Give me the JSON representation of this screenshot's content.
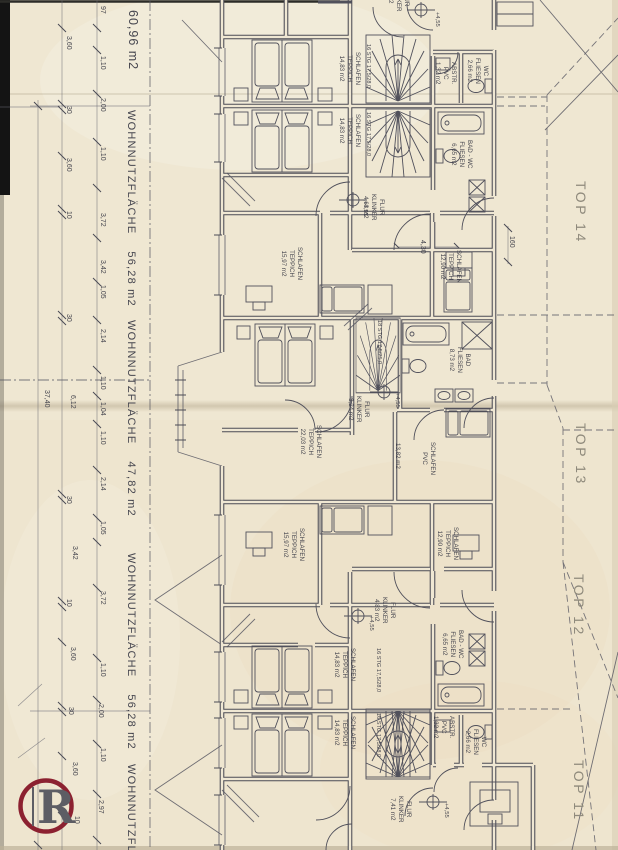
{
  "colors": {
    "paper": "#efe7d2",
    "ink": "#50505b",
    "faded_label": "#8f8a7c",
    "logo_ring": "#8c2130",
    "logo_letter": "#5d5d64"
  },
  "logo": {
    "letter": "R"
  },
  "labels": [
    {
      "n": "area-top",
      "t": "60,96 m2",
      "x": 141,
      "y": 10,
      "s": 12.5,
      "sp": 1
    },
    {
      "n": "area-top14",
      "t": "WOHNNUTZFLÄCHE    56,28 m2",
      "x": 138,
      "y": 110,
      "s": 11,
      "sp": 1.2
    },
    {
      "n": "area-top13",
      "t": "WOHNNUTZFLÄCHE    47,82 m2",
      "x": 138,
      "y": 320,
      "s": 11,
      "sp": 1.2
    },
    {
      "n": "area-top12",
      "t": "WOHNNUTZFLÄCHE    56,28 m2",
      "x": 138,
      "y": 553,
      "s": 11,
      "sp": 1.2
    },
    {
      "n": "area-top11",
      "t": "WOHNNUTZFLÄCHE",
      "x": 138,
      "y": 764,
      "s": 11,
      "sp": 1.2
    },
    {
      "n": "top-14",
      "t": "TOP 14",
      "x": 590,
      "y": 181,
      "s": 14,
      "sp": 2.5,
      "c": "#8f8a7c"
    },
    {
      "n": "top-13",
      "t": "TOP 13",
      "x": 590,
      "y": 423,
      "s": 14,
      "sp": 2.5,
      "c": "#8f8a7c"
    },
    {
      "n": "top-12",
      "t": "TOP 12",
      "x": 588,
      "y": 574,
      "s": 14,
      "sp": 2.5,
      "c": "#8f8a7c"
    },
    {
      "n": "top-11",
      "t": "TOP 11",
      "x": 588,
      "y": 760,
      "s": 14,
      "sp": 2.5,
      "c": "#8f8a7c"
    },
    {
      "n": "dim-97",
      "t": "97",
      "x": 107,
      "y": 6,
      "s": 7
    },
    {
      "n": "dim-360-a",
      "t": "3,60",
      "x": 73,
      "y": 36,
      "s": 7
    },
    {
      "n": "dim-110-a",
      "t": "1,10",
      "x": 107,
      "y": 56,
      "s": 7
    },
    {
      "n": "dim-200-a",
      "t": "2,00",
      "x": 107,
      "y": 98,
      "s": 7
    },
    {
      "n": "dim-30-a",
      "t": "30",
      "x": 73,
      "y": 106,
      "s": 7
    },
    {
      "n": "dim-110-b",
      "t": "1,10",
      "x": 107,
      "y": 147,
      "s": 7
    },
    {
      "n": "dim-360-b",
      "t": "3,60",
      "x": 73,
      "y": 158,
      "s": 7
    },
    {
      "n": "dim-372-a",
      "t": "3,72",
      "x": 107,
      "y": 213,
      "s": 7
    },
    {
      "n": "dim-10-a",
      "t": "10",
      "x": 73,
      "y": 211,
      "s": 7
    },
    {
      "n": "dim-342-a",
      "t": "3,42",
      "x": 107,
      "y": 260,
      "s": 7
    },
    {
      "n": "dim-105-a",
      "t": "1,05",
      "x": 107,
      "y": 285,
      "s": 7
    },
    {
      "n": "dim-30-b",
      "t": "30",
      "x": 73,
      "y": 314,
      "s": 7
    },
    {
      "n": "dim-214-a",
      "t": "2,14",
      "x": 107,
      "y": 329,
      "s": 7
    },
    {
      "n": "dim-110-c",
      "t": "1,10",
      "x": 107,
      "y": 376,
      "s": 7
    },
    {
      "n": "dim-104",
      "t": "1,04",
      "x": 107,
      "y": 402,
      "s": 7
    },
    {
      "n": "dim-612",
      "t": "6,12",
      "x": 77,
      "y": 395,
      "s": 7
    },
    {
      "n": "dim-3740",
      "t": "37,40",
      "x": 51,
      "y": 390,
      "s": 7
    },
    {
      "n": "dim-110-d",
      "t": "1,10",
      "x": 107,
      "y": 431,
      "s": 7
    },
    {
      "n": "dim-214-b",
      "t": "2,14",
      "x": 107,
      "y": 477,
      "s": 7
    },
    {
      "n": "dim-30-c",
      "t": "30",
      "x": 73,
      "y": 496,
      "s": 7
    },
    {
      "n": "dim-105-b",
      "t": "1,05",
      "x": 107,
      "y": 521,
      "s": 7
    },
    {
      "n": "dim-342-b",
      "t": "3,42",
      "x": 79,
      "y": 546,
      "s": 7
    },
    {
      "n": "dim-372-b",
      "t": "3,72",
      "x": 107,
      "y": 591,
      "s": 7
    },
    {
      "n": "dim-10-b",
      "t": "10",
      "x": 73,
      "y": 599,
      "s": 7
    },
    {
      "n": "dim-360-c",
      "t": "3,60",
      "x": 77,
      "y": 647,
      "s": 7
    },
    {
      "n": "dim-110-e",
      "t": "1,10",
      "x": 107,
      "y": 663,
      "s": 7
    },
    {
      "n": "dim-200-b",
      "t": "2,00",
      "x": 105,
      "y": 704,
      "s": 7
    },
    {
      "n": "dim-30-d",
      "t": "30",
      "x": 75,
      "y": 707,
      "s": 7
    },
    {
      "n": "dim-110-f",
      "t": "1,10",
      "x": 107,
      "y": 748,
      "s": 7
    },
    {
      "n": "dim-360-d",
      "t": "3,60",
      "x": 79,
      "y": 762,
      "s": 7
    },
    {
      "n": "dim-297",
      "t": "2,97",
      "x": 105,
      "y": 800,
      "s": 7
    },
    {
      "n": "dim-10-c",
      "t": "10",
      "x": 81,
      "y": 816,
      "s": 7
    },
    {
      "n": "dim-160",
      "t": "160",
      "x": 516,
      "y": 236,
      "s": 7
    },
    {
      "n": "dim-430",
      "t": "4,30",
      "x": 427,
      "y": 240,
      "s": 7
    },
    {
      "n": "room-schlafen-a",
      "t": "SCHLAFEN\nTEPPICH\n14,83 m2",
      "x": 361,
      "y": 52,
      "s": 6.2
    },
    {
      "n": "stairs-note-a",
      "t": "16 STG 17,5/28,0",
      "x": 371,
      "y": 44,
      "s": 5.6
    },
    {
      "n": "room-wc-a",
      "t": "WC\nFLIESEN\n2,66 m2",
      "x": 489,
      "y": 58,
      "s": 6.2
    },
    {
      "n": "room-abstr-a",
      "t": "ABSTR.\nPVC\n1,32 m2",
      "x": 457,
      "y": 62,
      "s": 6.2
    },
    {
      "n": "elev-a",
      "t": "+4,55",
      "x": 440,
      "y": 12,
      "s": 5.8
    },
    {
      "n": "room-flur-cut",
      "t": "FLUR\nKLINKER\n m2",
      "x": 410,
      "y": -15,
      "s": 6.2
    },
    {
      "n": "room-schlafen-b",
      "t": "SCHLAFEN\nTEPPICH\n14,83 m2",
      "x": 361,
      "y": 114,
      "s": 6.2
    },
    {
      "n": "stairs-note-b",
      "t": "16 STG 17,5/28,0",
      "x": 371,
      "y": 112,
      "s": 5.6
    },
    {
      "n": "room-badwc-b",
      "t": "BAD - WC\nFLIESEN\n6,65 m2",
      "x": 473,
      "y": 140,
      "s": 6.2
    },
    {
      "n": "room-flur-b",
      "t": "FLUR\nKLINKER\n4,63 m2",
      "x": 385,
      "y": 194,
      "s": 6.2
    },
    {
      "n": "elev-b",
      "t": "+4,55",
      "x": 368,
      "y": 201,
      "s": 5.8
    },
    {
      "n": "room-schlafen-c",
      "t": "SCHLAFEN\nTEPPICH\n15,97 m2",
      "x": 303,
      "y": 247,
      "s": 6.2
    },
    {
      "n": "room-schlafen-d",
      "t": "SCHLAFEN\nTEPPICH\n12,90 m2",
      "x": 462,
      "y": 250,
      "s": 6.2
    },
    {
      "n": "room-schlafen-e",
      "t": "SCHLAFEN\nTEPPICH\n22,03 m2",
      "x": 322,
      "y": 425,
      "s": 6.2
    },
    {
      "n": "stairs-note-c",
      "t": "18 STG 17,5/25,0",
      "x": 382,
      "y": 320,
      "s": 5.6
    },
    {
      "n": "room-bad-c",
      "t": "BAD\nFLIESEN\n8,73 m2",
      "x": 471,
      "y": 347,
      "s": 6.2
    },
    {
      "n": "room-flur-c",
      "t": "FLUR\nKLINKER\n3,24 m2",
      "x": 370,
      "y": 396,
      "s": 6.2
    },
    {
      "n": "elev-c",
      "t": "+4,55",
      "x": 400,
      "y": 393,
      "s": 5.8
    },
    {
      "n": "room-schlafen-pvc",
      "t": "SCHLAFEN\nPVC",
      "x": 436,
      "y": 442,
      "s": 6.2
    },
    {
      "n": "area-1382",
      "t": "13,82 m2",
      "x": 401,
      "y": 443,
      "s": 6.2
    },
    {
      "n": "room-schlafen-f",
      "t": "SCHLAFEN\nTEPPICH\n12,90 m2",
      "x": 459,
      "y": 527,
      "s": 6.2
    },
    {
      "n": "room-schlafen-g",
      "t": "SCHLAFEN\nTEPPICH\n15,97 m2",
      "x": 305,
      "y": 528,
      "s": 6.2
    },
    {
      "n": "room-flur-d",
      "t": "FLUR\nKLINKER\n4,83 m2",
      "x": 396,
      "y": 597,
      "s": 6.2
    },
    {
      "n": "elev-d",
      "t": "+4,55",
      "x": 374,
      "y": 616,
      "s": 5.8
    },
    {
      "n": "room-badwc-d",
      "t": "BAD - WC\nFLIESEN\n6,65 m2",
      "x": 464,
      "y": 630,
      "s": 6.2
    },
    {
      "n": "room-schlafen-h",
      "t": "SCHLAFEN\nTEPPICH\n14,83 m2",
      "x": 356,
      "y": 648,
      "s": 6.2
    },
    {
      "n": "stairs-note-d",
      "t": "16 STG 17,5/28,0",
      "x": 381,
      "y": 648,
      "s": 5.6
    },
    {
      "n": "room-schlafen-i",
      "t": "SCHLAFEN\nTEPPICH\n14,83 m2",
      "x": 356,
      "y": 716,
      "s": 6.2
    },
    {
      "n": "stairs-note-e",
      "t": "16 STG 17,5/28,0",
      "x": 381,
      "y": 713,
      "s": 5.6
    },
    {
      "n": "room-abstr-b",
      "t": "ABSTR.\nPVC\n1,32 m2",
      "x": 455,
      "y": 716,
      "s": 6.2
    },
    {
      "n": "room-wc-b",
      "t": "WC\nFLIESEN\n2,66 m2",
      "x": 487,
      "y": 729,
      "s": 6.2
    },
    {
      "n": "room-flur-e",
      "t": "FLUR\nKLINKER\n7,41 m2",
      "x": 412,
      "y": 796,
      "s": 6.2
    },
    {
      "n": "elev-e",
      "t": "+4,55",
      "x": 449,
      "y": 803,
      "s": 5.8
    }
  ]
}
